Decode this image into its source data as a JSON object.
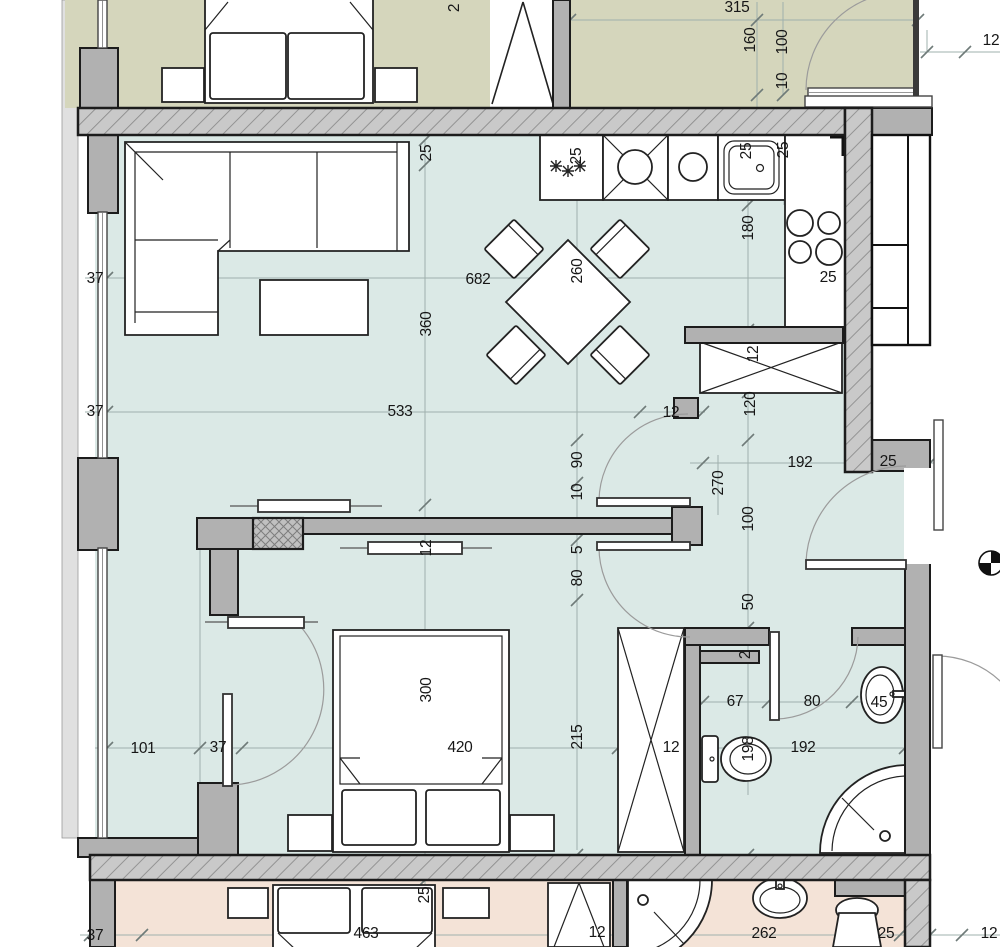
{
  "document": {
    "kind": "architectural-floor-plan",
    "description": "Apartment plan: living room with kitchen, bedroom, bathroom, hall; adjacent unit rooms above and below",
    "units": "cm"
  },
  "colors": {
    "main_room_fill": "#dbe9e6",
    "upper_room_fill": "#d5d6bc",
    "lower_room_fill": "#f4e3d7",
    "wall_fill": "#b1b1b1",
    "wall_hatch_bg": "#c9c9c9",
    "wall_hatch_line": "#8d8d8d",
    "outline": "#1c1c1c",
    "dim_line": "#9fb0ad",
    "tick": "#6f7b79",
    "label_text": "#161616",
    "facade_strip": "#e0e0e0",
    "arc_line": "#9b9b9b"
  },
  "fixtures": [
    "sofa-icon",
    "coffee-table-icon",
    "dining-table-icon",
    "dining-chair-icon",
    "fridge-freezer-icon",
    "kitchen-sink-icon",
    "cooktop-icon",
    "double-bed-icon",
    "nightstand-icon",
    "wardrobe-icon",
    "toilet-icon",
    "washbasin-icon",
    "corner-shower-icon",
    "door-swing-arc-icon",
    "sliding-door-icon",
    "window-icon",
    "shaft-icon",
    "section-marker-icon",
    "snowflake-icon",
    "door-leaf-triangle-icon"
  ],
  "dimension_labels": [
    {
      "text": "2",
      "x": 455,
      "y": 8,
      "rot": true
    },
    {
      "text": "315",
      "x": 737,
      "y": 8,
      "rot": false
    },
    {
      "text": "160",
      "x": 751,
      "y": 40,
      "rot": true
    },
    {
      "text": "100",
      "x": 783,
      "y": 42,
      "rot": true
    },
    {
      "text": "10",
      "x": 783,
      "y": 81,
      "rot": true
    },
    {
      "text": "12",
      "x": 991,
      "y": 41,
      "rot": false
    },
    {
      "text": "25",
      "x": 427,
      "y": 153,
      "rot": true
    },
    {
      "text": "25",
      "x": 577,
      "y": 156,
      "rot": true
    },
    {
      "text": "25",
      "x": 747,
      "y": 151,
      "rot": true
    },
    {
      "text": "25",
      "x": 784,
      "y": 150,
      "rot": true
    },
    {
      "text": "180",
      "x": 749,
      "y": 228,
      "rot": true
    },
    {
      "text": "37",
      "x": 95,
      "y": 279,
      "rot": false
    },
    {
      "text": "682",
      "x": 478,
      "y": 280,
      "rot": false
    },
    {
      "text": "260",
      "x": 578,
      "y": 271,
      "rot": true
    },
    {
      "text": "25",
      "x": 828,
      "y": 278,
      "rot": false
    },
    {
      "text": "360",
      "x": 427,
      "y": 324,
      "rot": true
    },
    {
      "text": "12",
      "x": 754,
      "y": 354,
      "rot": true
    },
    {
      "text": "120",
      "x": 751,
      "y": 404,
      "rot": true
    },
    {
      "text": "37",
      "x": 95,
      "y": 412,
      "rot": false
    },
    {
      "text": "533",
      "x": 400,
      "y": 412,
      "rot": false
    },
    {
      "text": "12",
      "x": 671,
      "y": 413,
      "rot": false
    },
    {
      "text": "192",
      "x": 800,
      "y": 463,
      "rot": false
    },
    {
      "text": "25",
      "x": 888,
      "y": 462,
      "rot": false
    },
    {
      "text": "90",
      "x": 578,
      "y": 460,
      "rot": true
    },
    {
      "text": "270",
      "x": 719,
      "y": 483,
      "rot": true
    },
    {
      "text": "10",
      "x": 578,
      "y": 492,
      "rot": true
    },
    {
      "text": "100",
      "x": 749,
      "y": 519,
      "rot": true
    },
    {
      "text": "12",
      "x": 427,
      "y": 548,
      "rot": true
    },
    {
      "text": "5",
      "x": 578,
      "y": 550,
      "rot": true
    },
    {
      "text": "80",
      "x": 578,
      "y": 578,
      "rot": true
    },
    {
      "text": "50",
      "x": 749,
      "y": 602,
      "rot": true
    },
    {
      "text": "2",
      "x": 746,
      "y": 655,
      "rot": true
    },
    {
      "text": "300",
      "x": 427,
      "y": 690,
      "rot": true
    },
    {
      "text": "67",
      "x": 735,
      "y": 702,
      "rot": false
    },
    {
      "text": "80",
      "x": 812,
      "y": 702,
      "rot": false
    },
    {
      "text": "45",
      "x": 879,
      "y": 703,
      "rot": false
    },
    {
      "text": "101",
      "x": 143,
      "y": 749,
      "rot": false
    },
    {
      "text": "37",
      "x": 218,
      "y": 748,
      "rot": false
    },
    {
      "text": "420",
      "x": 460,
      "y": 748,
      "rot": false
    },
    {
      "text": "12",
      "x": 671,
      "y": 748,
      "rot": false
    },
    {
      "text": "198",
      "x": 749,
      "y": 749,
      "rot": true
    },
    {
      "text": "192",
      "x": 803,
      "y": 748,
      "rot": false
    },
    {
      "text": "215",
      "x": 578,
      "y": 737,
      "rot": true
    },
    {
      "text": "25",
      "x": 425,
      "y": 895,
      "rot": true
    },
    {
      "text": "37",
      "x": 95,
      "y": 936,
      "rot": false
    },
    {
      "text": "463",
      "x": 366,
      "y": 934,
      "rot": false
    },
    {
      "text": "12",
      "x": 597,
      "y": 933,
      "rot": false
    },
    {
      "text": "262",
      "x": 764,
      "y": 934,
      "rot": false
    },
    {
      "text": "25",
      "x": 886,
      "y": 934,
      "rot": false
    },
    {
      "text": "12",
      "x": 989,
      "y": 934,
      "rot": false
    }
  ]
}
